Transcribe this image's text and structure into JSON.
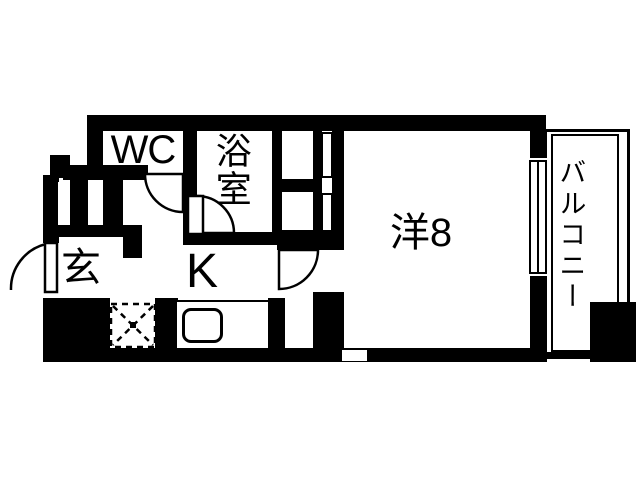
{
  "type": "apartment-floor-plan",
  "colors": {
    "wall": "#000000",
    "floor": "#ffffff"
  },
  "rooms": {
    "wc": {
      "label": "WC"
    },
    "bath": {
      "label": "浴室"
    },
    "western": {
      "label": "洋8"
    },
    "kitchen": {
      "label": "K"
    },
    "entrance": {
      "label": "玄"
    },
    "balcony": {
      "label": "バルコニー"
    }
  }
}
